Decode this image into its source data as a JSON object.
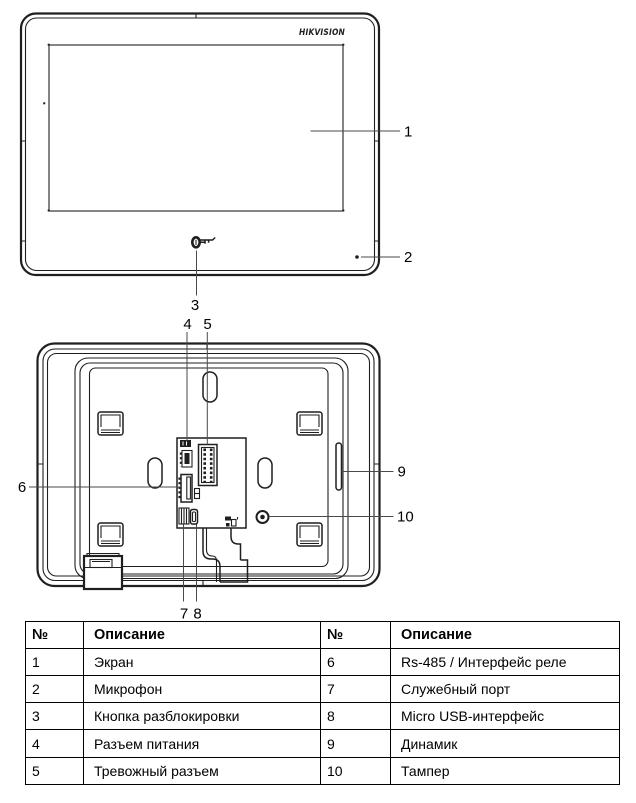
{
  "colors": {
    "line": "#1f1f1f",
    "leader": "#4a4a4a",
    "text": "#000000",
    "table_border": "#000000",
    "background": "#ffffff"
  },
  "brand": {
    "logo_text": "HIKVISION"
  },
  "callouts": {
    "c1": "1",
    "c2": "2",
    "c3": "3",
    "c4": "4",
    "c5": "5",
    "c6": "6",
    "c7": "7",
    "c8": "8",
    "c9": "9",
    "c10": "10"
  },
  "table": {
    "headers": [
      "№",
      "Описание",
      "№",
      "Описание"
    ],
    "rows": [
      [
        "1",
        "Экран",
        "6",
        "Rs-485 / Интерфейс реле"
      ],
      [
        "2",
        "Микрофон",
        "7",
        "Служебный порт"
      ],
      [
        "3",
        "Кнопка разблокировки",
        "8",
        "Micro USB-интерфейс"
      ],
      [
        "4",
        "Разъем питания",
        "9",
        "Динамик"
      ],
      [
        "5",
        "Тревожный разъем",
        "10",
        "Тампер"
      ]
    ]
  }
}
